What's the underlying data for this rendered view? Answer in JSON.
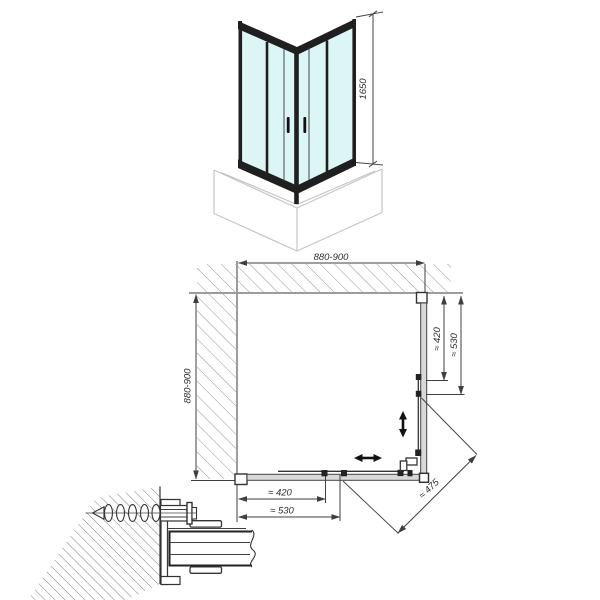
{
  "drawing_type": "shower-enclosure-technical-diagram",
  "labels": {
    "height": "1650",
    "width": "880-900",
    "depth": "880-900",
    "right_inner": "≈ 420",
    "right_outer": "≈ 530",
    "bottom_inner": "≈ 420",
    "bottom_outer": "≈ 530",
    "diagonal": "≈ 475"
  },
  "colors": {
    "glass": "#dcf6f6",
    "glass_edge": "#8fcfcf",
    "frame": "#1f1f1f",
    "profile_fill": "#d9d9d9",
    "wall_line": "#9c9c9c",
    "dim_line": "#3f3f3f",
    "ink": "#333333",
    "tray_line": "#c5c5c5",
    "hatch": "#8a8a8a",
    "hatch_detail": "#6f6f6f"
  }
}
